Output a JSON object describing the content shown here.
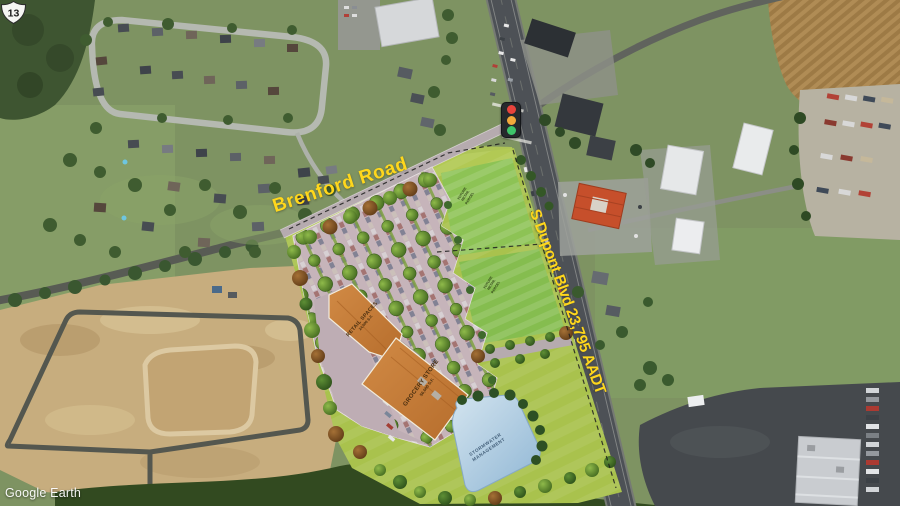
{
  "attribution": {
    "label": "Google Earth"
  },
  "labels": {
    "brenford_road": "Brenford Road",
    "dupont_blvd": "S Dupont Blvd 23,795 AADT",
    "route_shield_number": "13"
  },
  "site_plan": {
    "retail": {
      "name": "RETAIL SPACES",
      "area": "24,000 S.F."
    },
    "grocery": {
      "name": "GROCERY STORE",
      "area": "56,000 S.F."
    },
    "pond": {
      "line1": "STORMWATER",
      "line2": "MANAGEMENT"
    },
    "parcel_note_north": {
      "line1": "FUTURE",
      "line2": "RETAIL",
      "line3": "PARCEL"
    },
    "parcel_note_south": {
      "line1": "FUTURE",
      "line2": "RETAIL",
      "line3": "PARCEL"
    }
  },
  "colors": {
    "label_yellow": "#ffd71c",
    "signal_red": "#e8433c",
    "signal_amber": "#f2a93b",
    "signal_green": "#3ec46a",
    "plan_roof_orange": "#c97f3c",
    "plan_grass_green": "#a9c24d",
    "pond_blue": "#a8c8de"
  }
}
